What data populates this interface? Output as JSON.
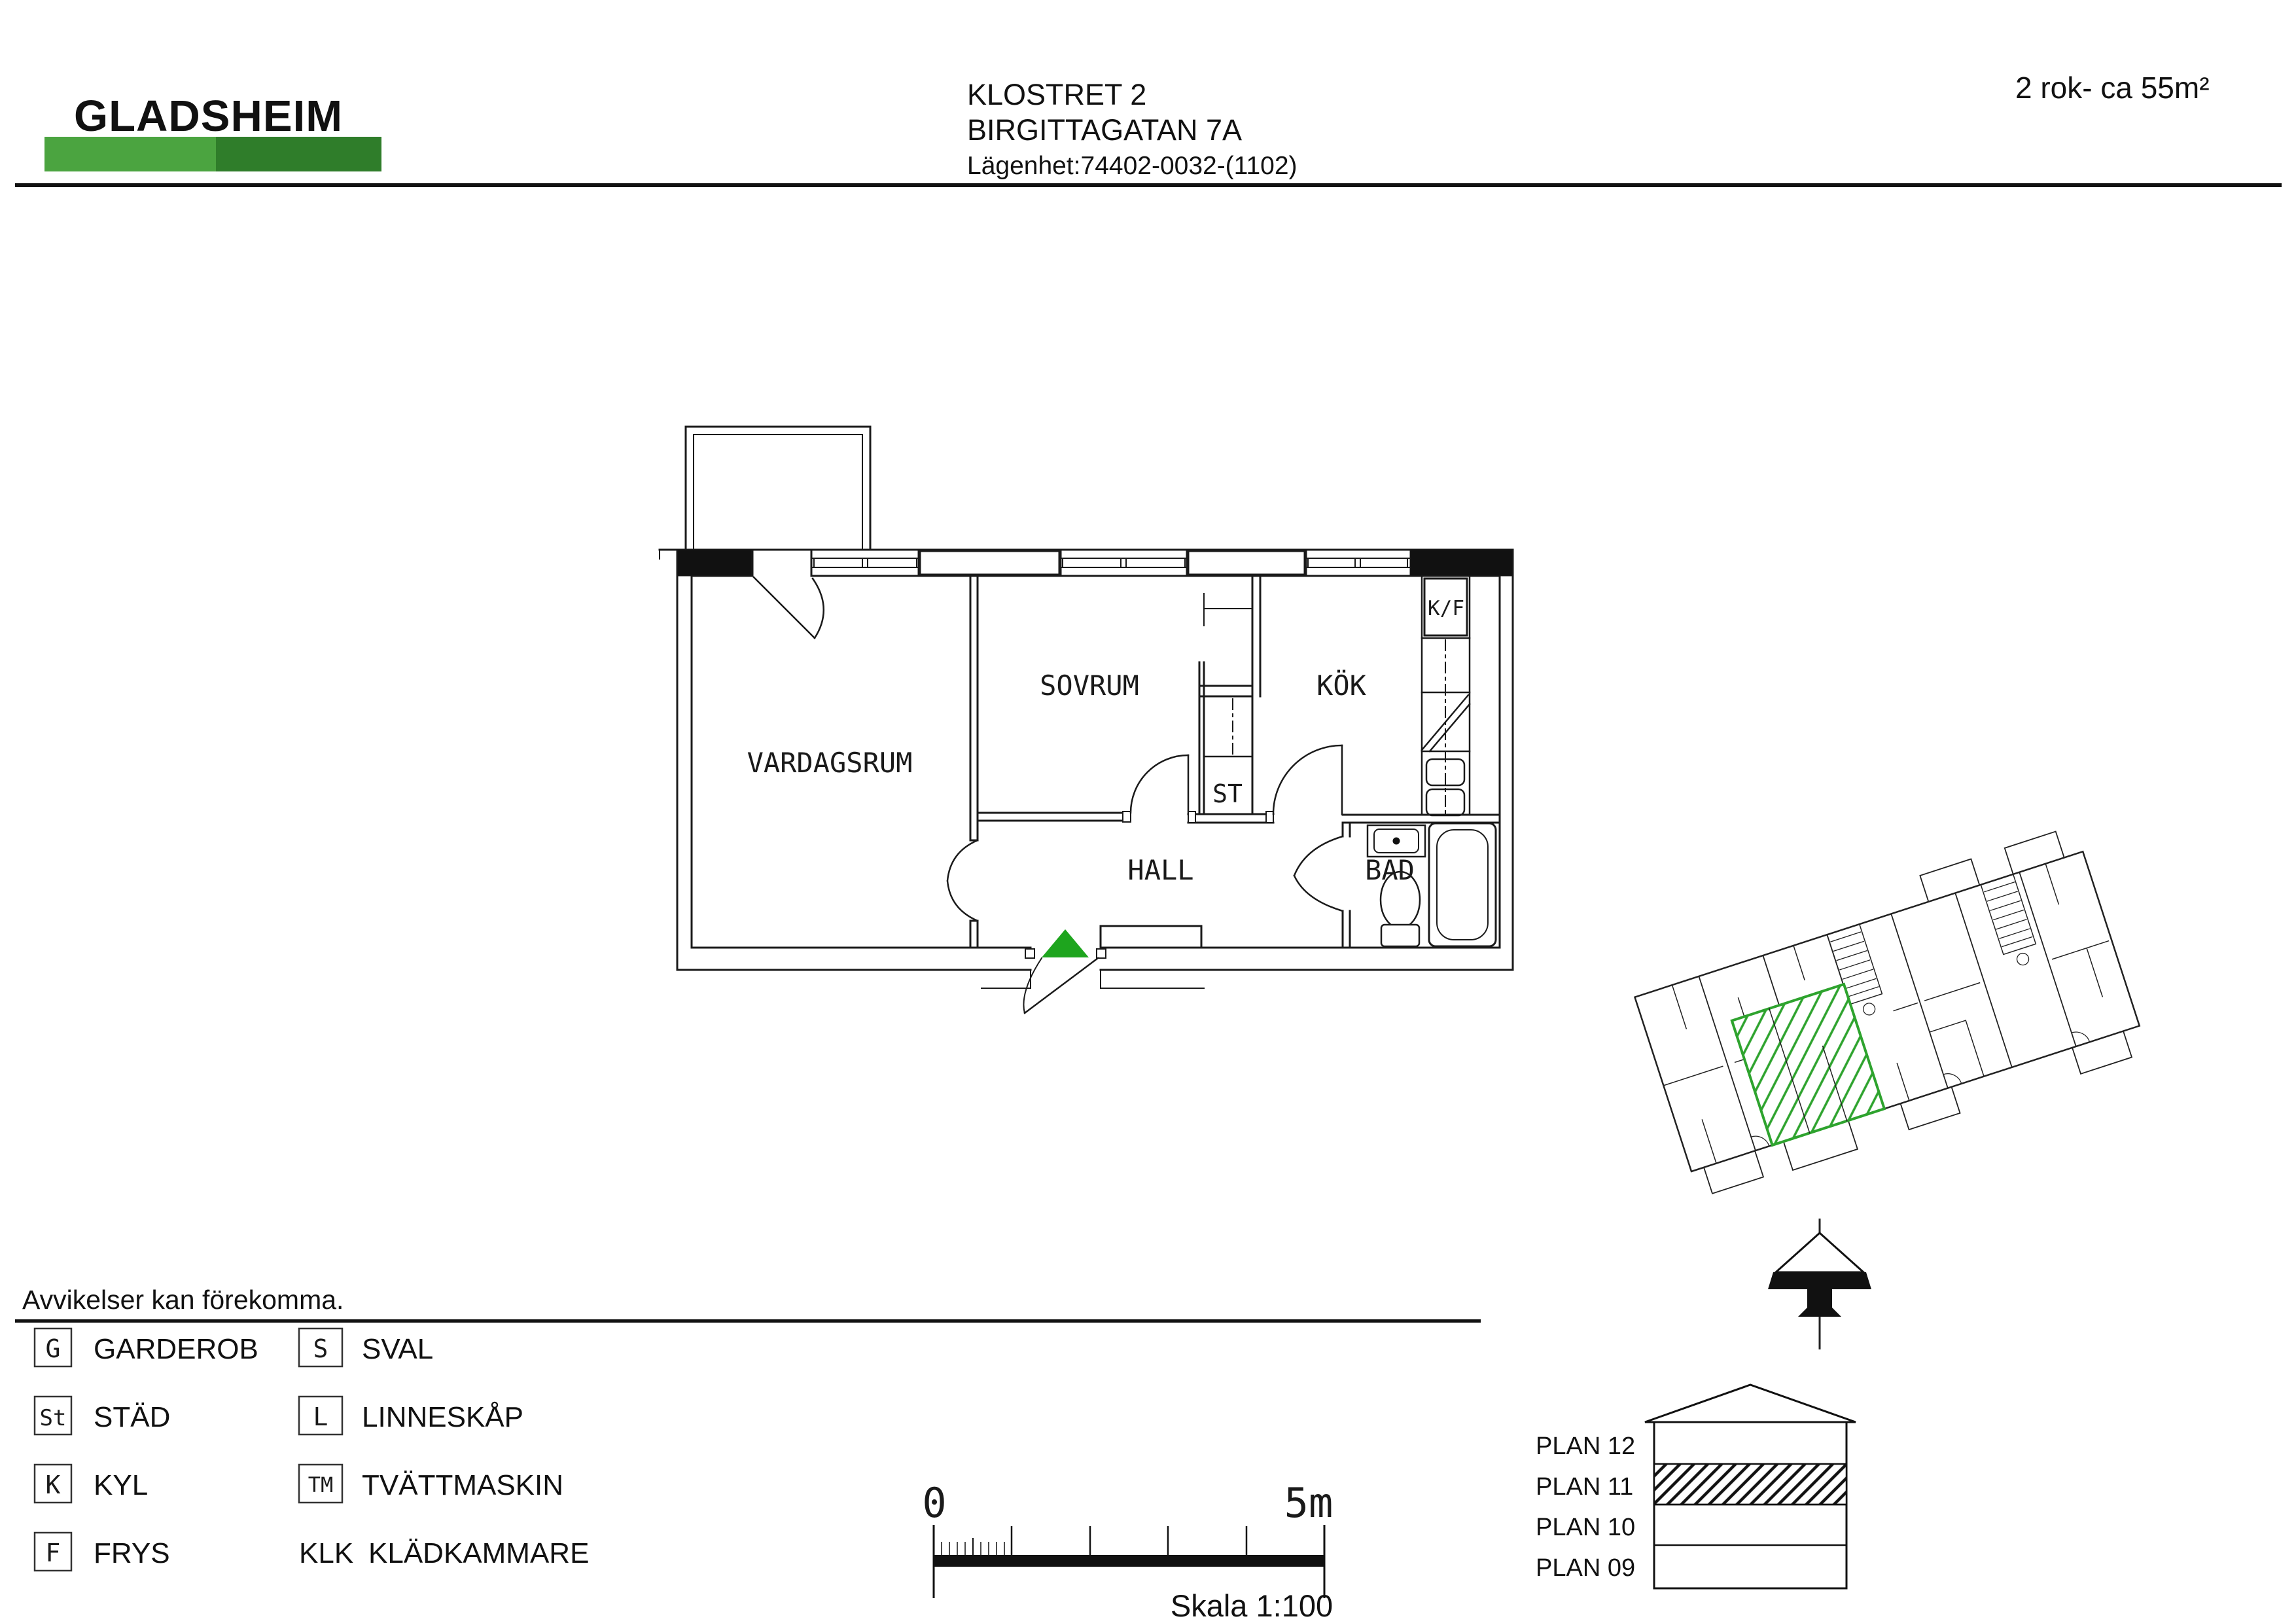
{
  "header": {
    "logo_text": "GLADSHEIM",
    "project": "KLOSTRET 2",
    "address": "BIRGITTAGATAN 7A",
    "apartment_no": "Lägenhet:74402-0032-(1102)",
    "apartment_size": "2 rok- ca 55m²"
  },
  "floor_plan": {
    "rooms": {
      "living": "VARDAGSRUM",
      "bedroom": "SOVRUM",
      "kitchen": "KÖK",
      "hall": "HALL",
      "bathroom": "BAD",
      "cleaning_closet": "ST",
      "fridge_freezer": "K/F"
    }
  },
  "disclaimer": "Avvikelser kan förekomma.",
  "legend": {
    "column1": [
      {
        "abbr": "G",
        "label": "GARDEROB"
      },
      {
        "abbr": "St",
        "label": "STÄD"
      },
      {
        "abbr": "K",
        "label": "KYL"
      },
      {
        "abbr": "F",
        "label": "FRYS"
      }
    ],
    "column2": [
      {
        "abbr": "S",
        "label": "SVAL"
      },
      {
        "abbr": "L",
        "label": "LINNESKÅP"
      },
      {
        "abbr": "TM",
        "label": "TVÄTTMASKIN"
      },
      {
        "abbr": "KLK",
        "label": "KLÄDKAMMARE"
      }
    ]
  },
  "scale_bar": {
    "start_label": "0",
    "end_label": "5m",
    "caption": "Skala 1:100"
  },
  "floor_selector": {
    "floors": [
      "PLAN 12",
      "PLAN 11",
      "PLAN 10",
      "PLAN 09"
    ],
    "highlighted": "PLAN 11"
  },
  "colors": {
    "logo_green": "#3aa335",
    "logo_bar_light": "#4ba440",
    "logo_bar_dark": "#2f7d2a",
    "entrance_marker_green": "#1ea51e",
    "site_plan_highlight_green": "#2ea32e"
  }
}
